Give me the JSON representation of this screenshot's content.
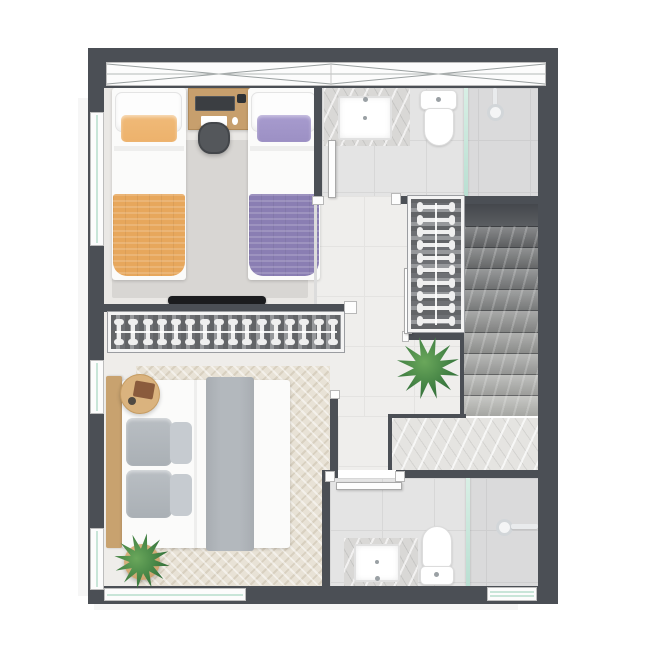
{
  "meta": {
    "kind": "residential floor plan",
    "view": "top-down 3d render",
    "level": "upper floor"
  },
  "palette": {
    "wall": "#4b4f55",
    "floor": "#eae8e5",
    "rug_twin": "#d8d6d3",
    "tile": "#e4e4e4",
    "tile_line": "#d7d7d7",
    "hall": "#efeeec",
    "glass": "#c8e5d8",
    "white": "#fcfcfc",
    "wood": "#c79f6d",
    "wood_light": "#dab37e",
    "orange": "#e7a75c",
    "orange_pillow": "#edb26c",
    "purple": "#8a7eb3",
    "purple_pillow": "#9c90c4",
    "gray_pillow": "#aab0b5",
    "gray_runner": "#b3b8bd",
    "tv_black": "#1b1c1e",
    "rack_bg": "#85878b",
    "plant_green": "#3e7d41"
  },
  "rooms": {
    "twin_bedroom": {
      "items": [
        "single-bed-orange",
        "single-bed-purple",
        "desk",
        "laptop",
        "desk-chair",
        "area-rug",
        "wall-tv"
      ]
    },
    "upper_bathroom": {
      "items": [
        "marble-vanity-sink",
        "toilet",
        "shower-head",
        "glass-partition",
        "door"
      ]
    },
    "hallway": {
      "items": [
        "clothes-rack",
        "potted-plant"
      ]
    },
    "stairwell": {
      "items": [
        "marble-steps",
        "landing",
        "void-edge"
      ]
    },
    "master_bedroom": {
      "items": [
        "double-bed",
        "wood-headboard",
        "round-side-table",
        "potted-plant",
        "herringbone-rug",
        "clothes-rack",
        "door"
      ]
    },
    "lower_bathroom": {
      "items": [
        "marble-vanity-sink",
        "toilet",
        "shower-head",
        "glass-partition",
        "door",
        "window"
      ]
    }
  },
  "staircase": {
    "steps": 9
  },
  "closets": {
    "master_rack_hangers": 16,
    "hall_rack_hangers": 10
  }
}
